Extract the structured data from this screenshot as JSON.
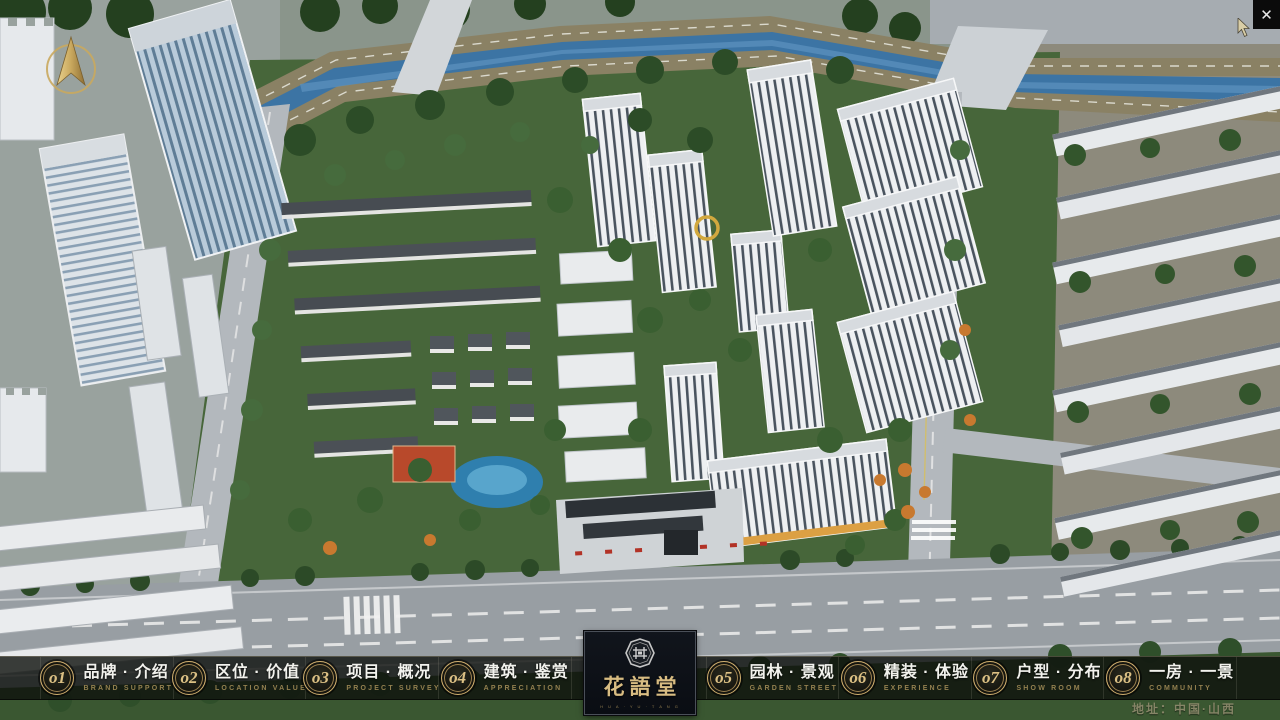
{
  "window": {
    "close_glyph": "✕"
  },
  "menu": {
    "items": [
      {
        "num": "o1",
        "zh": "品牌 · 介绍",
        "en": "BRAND SUPPORT"
      },
      {
        "num": "o2",
        "zh": "区位 · 价值",
        "en": "LOCATION VALUE"
      },
      {
        "num": "o3",
        "zh": "项目 · 概况",
        "en": "PROJECT SURVEY"
      },
      {
        "num": "o4",
        "zh": "建筑 · 鉴赏",
        "en": "APPRECIATION"
      },
      {
        "num": "o5",
        "zh": "园林 · 景观",
        "en": "GARDEN STREET"
      },
      {
        "num": "o6",
        "zh": "精装 · 体验",
        "en": "EXPERIENCE"
      },
      {
        "num": "o7",
        "zh": "户型 · 分布",
        "en": "SHOW ROOM"
      },
      {
        "num": "o8",
        "zh": "一房 · 一景",
        "en": "COMMUNITY"
      }
    ]
  },
  "logo": {
    "title": "花語堂",
    "tagline": "H U A · Y U · T A N G"
  },
  "footer": {
    "address": "地址：中国·山西"
  },
  "colors": {
    "gold": "#bfa066",
    "bar_bg": "rgba(14,16,13,0.80)",
    "river": "#3c74a4"
  }
}
